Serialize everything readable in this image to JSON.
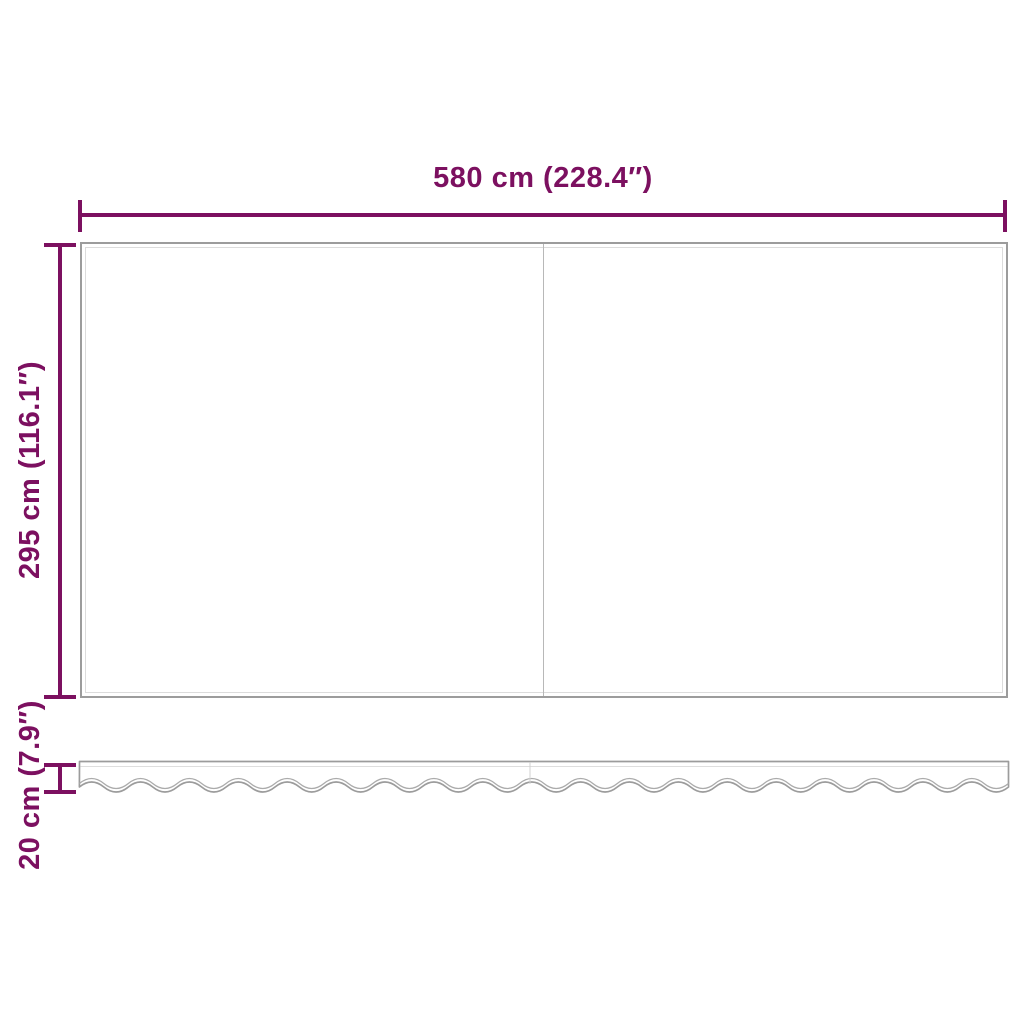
{
  "diagram": {
    "title": "awning-fabric-dimension-diagram",
    "width_label": "580 cm (228.4″)",
    "height_label": "295 cm (116.1″)",
    "valance_height_label": "20 cm (7.9″)"
  },
  "colors": {
    "dimension_accent": "#7c1060",
    "outline_gray": "#9c9c9c",
    "hem_gray": "#dcdcdc",
    "seam_gray": "#b8b8b8",
    "background": "#ffffff"
  }
}
